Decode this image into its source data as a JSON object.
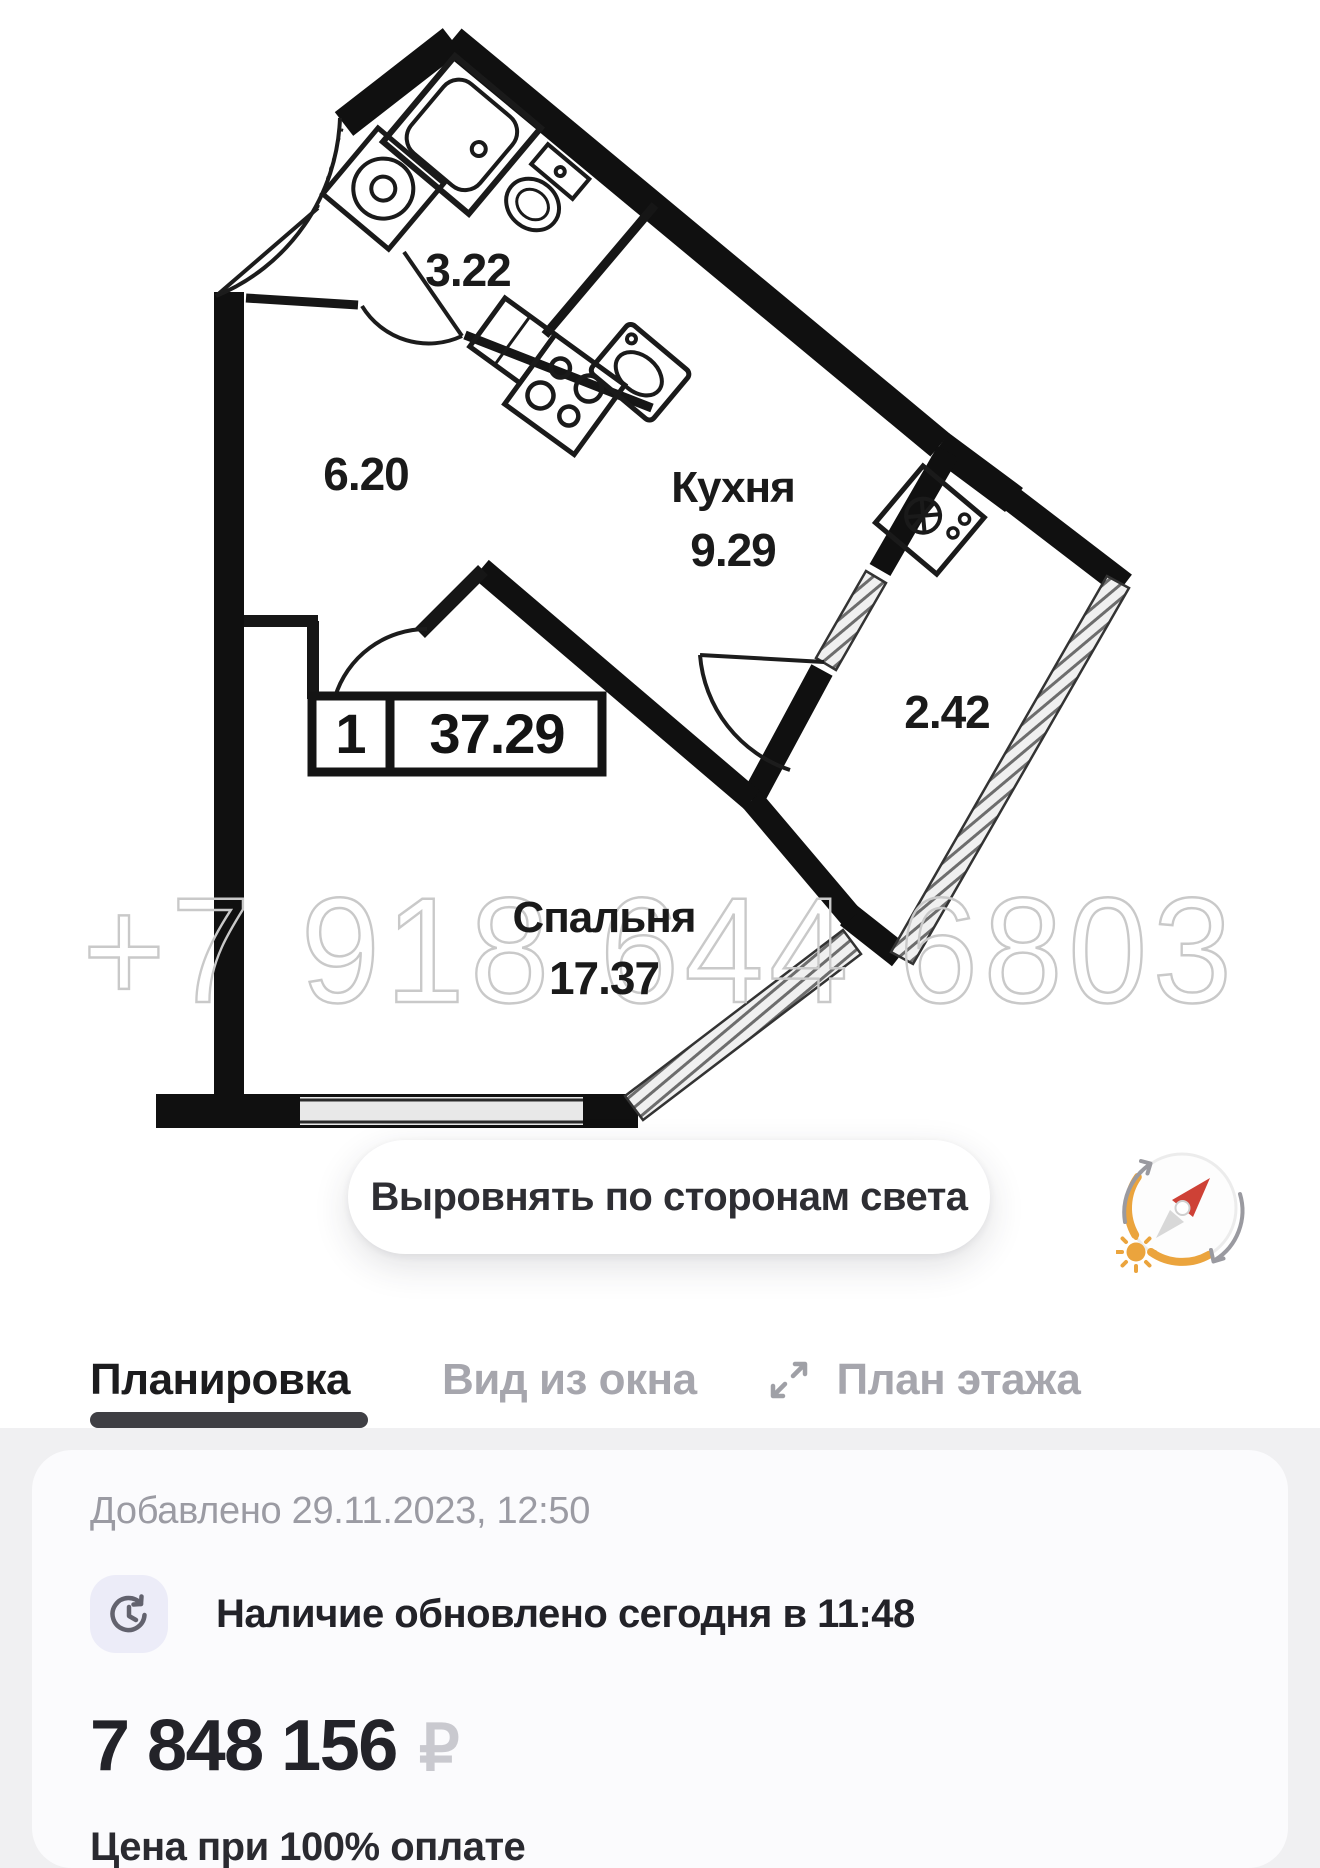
{
  "plan": {
    "watermark": "+7 918 644 6803",
    "unit_badge": {
      "rooms_count": "1",
      "total_area": "37.29"
    },
    "labels": {
      "bathroom_area": "3.22",
      "hallway_area": "6.20",
      "kitchen_name": "Кухня",
      "kitchen_area": "9.29",
      "balcony_area": "2.42",
      "bedroom_name": "Спальня",
      "bedroom_area": "17.37"
    },
    "align_button_label": "Выровнять по сторонам света"
  },
  "tabs": {
    "items": [
      {
        "label": "Планировка",
        "active": true
      },
      {
        "label": "Вид из окна",
        "active": false
      },
      {
        "label": "План этажа",
        "active": false
      }
    ]
  },
  "details_card": {
    "added_text": "Добавлено 29.11.2023, 12:50",
    "availability_text": "Наличие обновлено сегодня в 11:48",
    "price": "7 848 156",
    "currency_symbol": "₽",
    "price_note": "Цена при 100% оплате"
  },
  "icons": {
    "compass": "compass-with-sun-and-rotation-arrows",
    "clock": "clock-refresh",
    "expand": "diagonal-expand-arrows"
  },
  "colors": {
    "accent_orange": "#EBA43D",
    "needle_red": "#CE4136",
    "active_tab": "#1C1C1E",
    "inactive_tab": "#A6A6AD",
    "muted_text": "#9B9BA3",
    "currency_gray": "#C9C9CF",
    "section_bg": "#F0F0F2",
    "card_bg": "#FBFBFD",
    "icon_bubble_bg": "#ECECF8",
    "walls": "#101010",
    "watermark_gray": "#C9C9C9"
  }
}
